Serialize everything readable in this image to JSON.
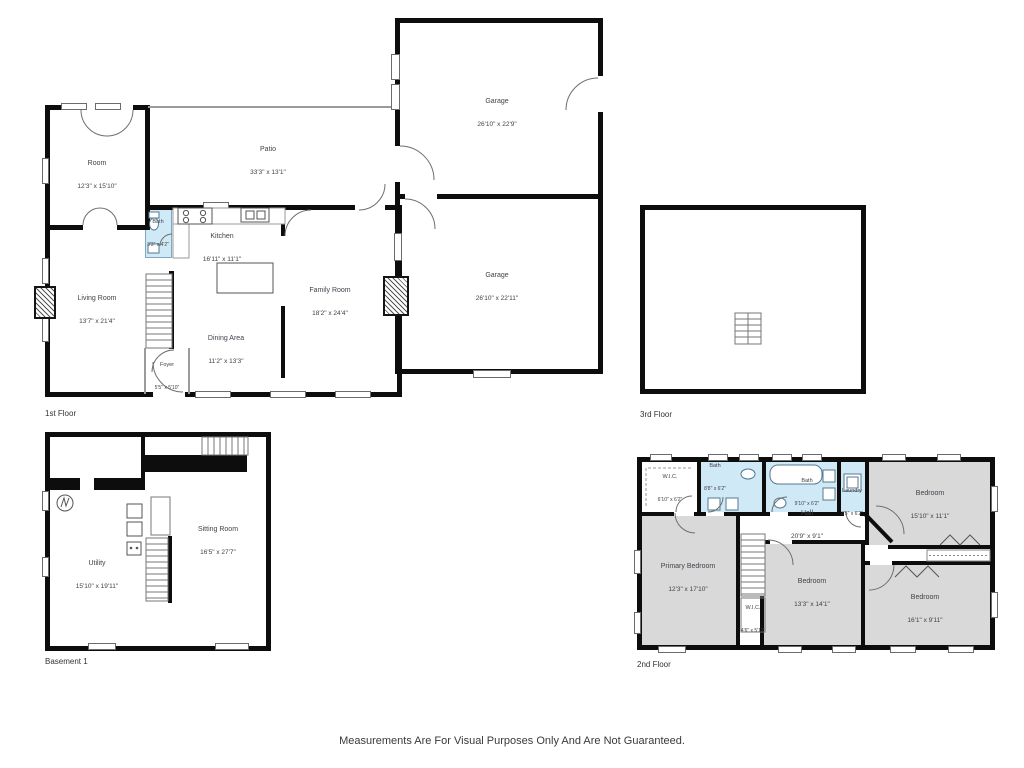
{
  "page": {
    "disclaimer": "Measurements Are For Visual Purposes Only And Are Not Guaranteed."
  },
  "colors": {
    "wall": "#0d0d0d",
    "bath_fill": "#cfe9f6",
    "bedroom_fill": "#d9d9d9",
    "floor_fill": "#ffffff"
  },
  "icons": [
    "stairs-icon",
    "stove-icon",
    "sink-icon",
    "toilet-icon",
    "tub-icon",
    "water-heater-icon",
    "washer-icon",
    "door-arc",
    "window-marker",
    "closet-zigzag"
  ],
  "floors": [
    {
      "id": "first",
      "label": "1st Floor",
      "rooms": [
        {
          "name": "Room",
          "dims": "12'3\" x 15'10\""
        },
        {
          "name": "Patio",
          "dims": "33'3\" x 13'1\""
        },
        {
          "name": "Garage",
          "dims": "26'10\" x 22'9\""
        },
        {
          "name": "Garage",
          "dims": "26'10\" x 22'11\""
        },
        {
          "name": "Bath",
          "dims": "3'3\" x 4'2\""
        },
        {
          "name": "Kitchen",
          "dims": "16'11\" x 11'1\""
        },
        {
          "name": "Living Room",
          "dims": "13'7\" x 21'4\""
        },
        {
          "name": "Family Room",
          "dims": "18'2\" x 24'4\""
        },
        {
          "name": "Dining Area",
          "dims": "11'2\" x 13'3\""
        },
        {
          "name": "Foyer",
          "dims": "5'5\" x 5'10\""
        }
      ]
    },
    {
      "id": "third",
      "label": "3rd Floor",
      "rooms": []
    },
    {
      "id": "basement",
      "label": "Basement 1",
      "rooms": [
        {
          "name": "Utility",
          "dims": "15'10\" x 19'11\""
        },
        {
          "name": "Sitting Room",
          "dims": "16'5\" x 27'7\""
        }
      ]
    },
    {
      "id": "second",
      "label": "2nd Floor",
      "rooms": [
        {
          "name": "W.I.C.",
          "dims": "6'10\" x 6'2\""
        },
        {
          "name": "Bath",
          "dims": "8'8\" x 6'2\""
        },
        {
          "name": "Bath",
          "dims": "9'10\" x 6'2\""
        },
        {
          "name": "Laundry",
          "dims": "3'5\" x 6'2\""
        },
        {
          "name": "Bedroom",
          "dims": "15'10\" x 11'1\""
        },
        {
          "name": "Hall",
          "dims": "20'9\" x 9'1\""
        },
        {
          "name": "Primary Bedroom",
          "dims": "12'3\" x 17'10\""
        },
        {
          "name": "Bedroom",
          "dims": "13'3\" x 14'1\""
        },
        {
          "name": "Bedroom",
          "dims": "16'1\" x 9'11\""
        },
        {
          "name": "W.I.C.",
          "dims": "4'6\" x 5'11\""
        }
      ]
    }
  ]
}
